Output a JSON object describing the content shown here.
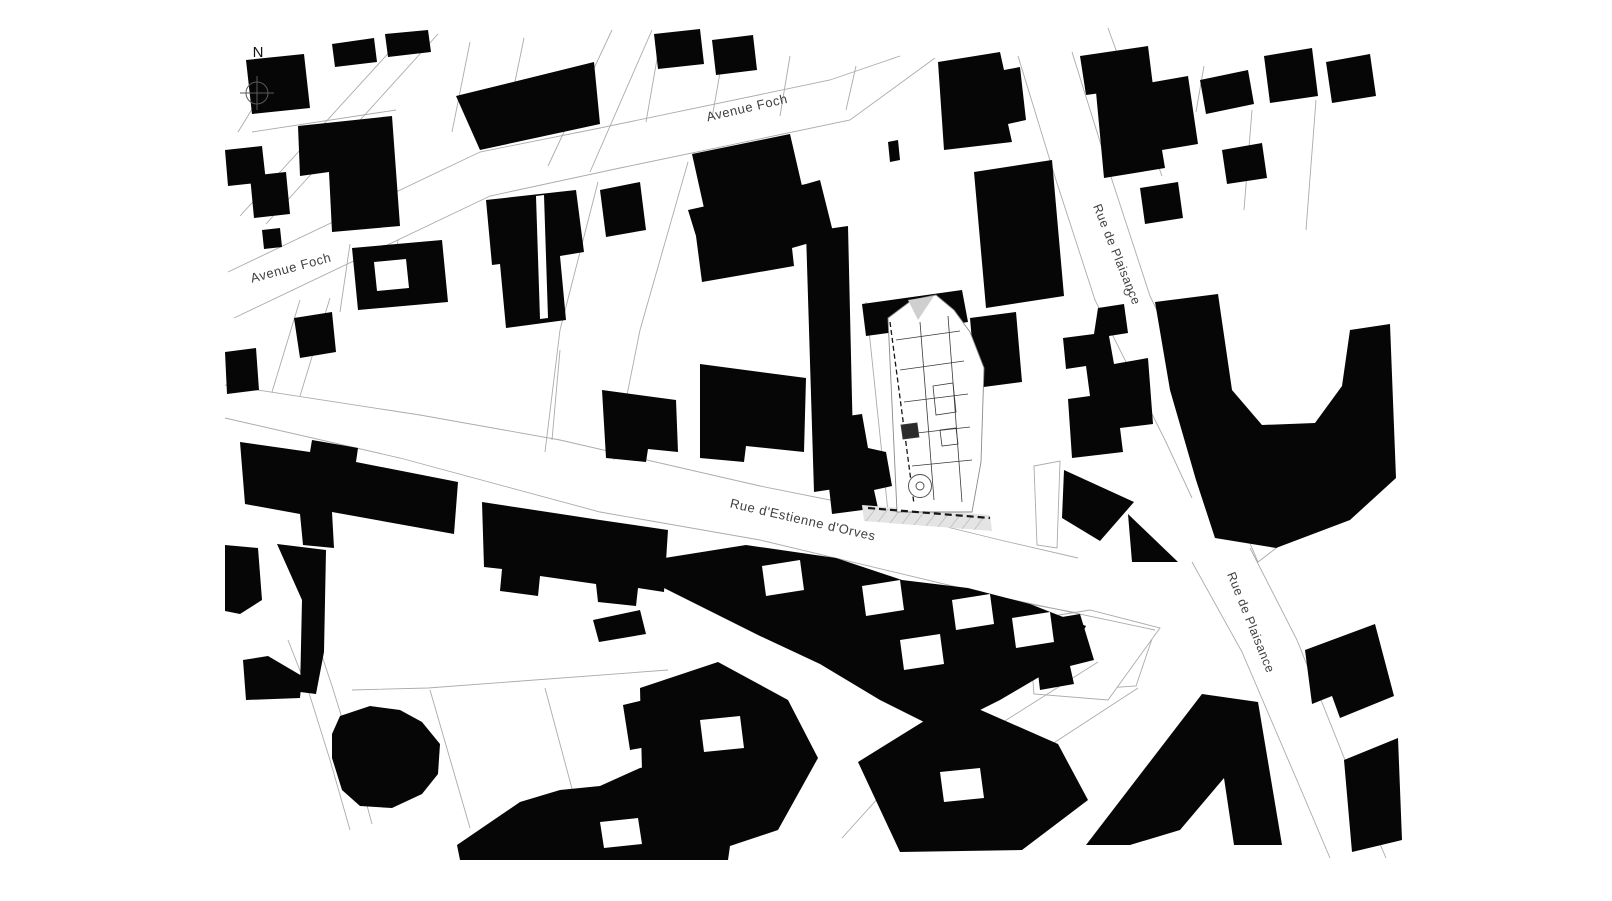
{
  "map": {
    "type": "architectural-site-plan-figure-ground",
    "colors": {
      "background": "#ffffff",
      "building": "#060606",
      "parcel_line": "#ababab",
      "label": "#3f3f3f",
      "site_line": "#3a3a3a",
      "hatch_fill": "#e4e4e4",
      "hatch_line": "#bbbbbb",
      "site_accent": "#cfcfcf"
    },
    "north": {
      "label": "N",
      "cx": 257,
      "cy": 93,
      "r": 11,
      "label_x": 258,
      "label_y": 76,
      "font": 15
    },
    "labels": [
      {
        "id": "avenue-foch-top",
        "text": "Avenue Foch",
        "x": 748,
        "y": 112,
        "rotate": -13,
        "size": 13
      },
      {
        "id": "avenue-foch-left",
        "text": "Avenue Foch",
        "x": 292,
        "y": 272,
        "rotate": -15,
        "size": 13
      },
      {
        "id": "rue-de-plaisance-top",
        "text": "Rue de Plaisance",
        "x": 1113,
        "y": 256,
        "rotate": 68,
        "size": 12.5
      },
      {
        "id": "rue-de-plaisance-bottom",
        "text": "Rue de Plaisance",
        "x": 1247,
        "y": 624,
        "rotate": 68,
        "size": 12.5
      },
      {
        "id": "rue-destienne-dorves",
        "text": "Rue d'Estienne d'Orves",
        "x": 802,
        "y": 524,
        "rotate": 13,
        "size": 13
      }
    ],
    "blocks": [
      "990,597 1100,617 1155,630 1136,686 1048,692 992,642",
      "1034,466 1060,461 1057,548 1037,545",
      "1240,520 1284,542 1258,562",
      "1028,620 1090,610 1160,628 1108,700 1034,694"
    ],
    "parcel_lines": [
      [
        228,
        272,
        480,
        152,
        600,
        128,
        830,
        80,
        900,
        56
      ],
      [
        234,
        318,
        490,
        196,
        620,
        168,
        850,
        120,
        935,
        58
      ],
      [
        404,
        36,
        240,
        216
      ],
      [
        438,
        34,
        266,
        224
      ],
      [
        300,
        300,
        272,
        392
      ],
      [
        330,
        298,
        300,
        396
      ],
      [
        612,
        30,
        548,
        166
      ],
      [
        652,
        30,
        590,
        172
      ],
      [
        598,
        182,
        560,
        330,
        545,
        452
      ],
      [
        688,
        162,
        640,
        330,
        614,
        460
      ],
      [
        1018,
        56,
        1056,
        180,
        1095,
        300,
        1165,
        440,
        1192,
        498
      ],
      [
        1072,
        52,
        1112,
        180,
        1150,
        296,
        1218,
        436,
        1248,
        500
      ],
      [
        225,
        385,
        420,
        415,
        560,
        440,
        760,
        486,
        870,
        508,
        1000,
        540,
        1078,
        558
      ],
      [
        225,
        418,
        400,
        458,
        600,
        512,
        760,
        540,
        990,
        595,
        1155,
        630
      ],
      [
        1138,
        688,
        1046,
        748,
        938,
        812,
        900,
        845
      ],
      [
        1098,
        662,
        1000,
        724,
        880,
        796,
        842,
        838
      ],
      [
        1192,
        562,
        1242,
        652,
        1302,
        792,
        1330,
        858
      ],
      [
        1250,
        548,
        1297,
        640,
        1357,
        790,
        1386,
        858
      ],
      [
        312,
        626,
        332,
        686,
        352,
        750,
        372,
        824
      ],
      [
        288,
        640,
        310,
        696,
        330,
        760,
        350,
        830
      ],
      [
        285,
        56,
        238,
        132
      ],
      [
        252,
        132,
        396,
        110
      ],
      [
        470,
        42,
        452,
        132
      ],
      [
        524,
        38,
        505,
        130
      ],
      [
        660,
        42,
        646,
        122
      ],
      [
        724,
        50,
        712,
        118
      ],
      [
        790,
        56,
        780,
        116
      ],
      [
        856,
        66,
        846,
        110
      ],
      [
        350,
        244,
        340,
        312
      ],
      [
        398,
        240,
        390,
        304
      ],
      [
        560,
        350,
        552,
        440
      ],
      [
        430,
        690,
        470,
        828
      ],
      [
        545,
        688,
        575,
        800
      ],
      [
        352,
        690,
        428,
        688,
        668,
        670
      ],
      [
        1140,
        52,
        1152,
        96
      ],
      [
        1204,
        66,
        1196,
        112
      ],
      [
        1108,
        28,
        1162,
        176
      ],
      [
        1252,
        110,
        1244,
        210
      ],
      [
        1316,
        100,
        1306,
        230
      ],
      [
        866,
        302,
        888,
        512
      ]
    ],
    "buildings": [
      "246,60 304,54 310,108 252,114",
      "298,126 392,116 400,226 332,232 329,172 300,176",
      "250,176 286,172 290,214 254,218",
      "262,230 280,228 282,247 264,249",
      "332,44 374,38 377,62 335,67",
      "385,34 428,30 431,52 388,57",
      "456,96 594,62 600,124 480,150",
      "486,200 576,190 584,252 560,256 566,320 506,328 500,264 492,265",
      "600,190 640,182 646,230 606,237",
      "654,34 700,29 704,64 658,69",
      "712,40 753,35 757,70 716,75",
      "692,154 790,134 802,186 704,208",
      "688,210 806,184 820,180 834,236 792,248 794,266 702,282 696,236",
      "938,62 1000,52 1004,70 1020,67 1026,120 1008,124 1012,142 944,150",
      "888,142 898,140 900,160 890,162",
      "974,172 1052,160 1064,296 986,308",
      "862,304 962,290 968,322 942,326 946,352 900,358 896,332 866,336",
      "970,318 1016,312 1022,382 976,388",
      "1098,308 1124,304 1128,333 1109,336 1114,364 1148,358 1153,424 1120,428 1123,452 1072,458 1068,399 1090,396 1086,366 1066,369 1063,338 1094,334",
      "1080,56 1148,46 1153,86 1086,95",
      "1096,92 1188,76 1198,144 1162,150 1165,168 1104,178",
      "1200,80 1248,70 1254,104 1206,114",
      "1264,56 1312,48 1318,96 1270,103",
      "1326,62 1370,54 1376,96 1332,103",
      "1140,188 1178,182 1183,218 1145,224",
      "1222,150 1262,143 1267,178 1227,184",
      "1155,302 1218,294 1232,390 1262,425 1315,423 1342,386 1350,330 1390,324 1396,478 1350,520 1276,548 1215,538 1196,480 1170,390",
      "1128,514 1178,562 1132,562",
      "1064,470 1134,502 1100,541 1062,518",
      "1086,845 1202,694 1258,702 1282,845 1234,845 1224,778 1180,830 1130,845",
      "1305,650 1375,624 1394,696 1340,718 1332,696 1312,704",
      "1344,760 1398,738 1402,840 1352,852",
      "1032,622 1080,614 1094,660 1070,666 1074,684 1040,690",
      "652,560 746,545 836,558 902,580 968,588 1030,604 1086,626 1068,660 1000,700 940,730 880,700 820,664 760,636 700,606 664,588",
      "640,688 718,662 788,700 818,758 778,830 700,856 644,856",
      "858,762 958,700 1058,744 1088,800 1022,850 900,852",
      "352,248 442,240 448,302 358,310",
      "294,318 332,312 336,352 300,358",
      "225,352 256,348 259,390 227,394",
      "240,442 310,452 312,440 358,448 356,462 458,482 454,534 332,512 334,548 303,545 300,514 245,504",
      "277,544 326,550 324,652 316,694 300,692 302,600",
      "243,660 268,656 302,676 300,698 246,700",
      "225,545 258,548 262,600 240,614 225,611",
      "482,502 600,520 668,530 664,592 638,588 636,606 598,602 596,584 540,576 538,596 500,591 502,569 484,567",
      "340,716 370,706 400,710 422,722 440,744 438,774 422,794 392,808 360,806 342,790 332,758 332,734",
      "457,845 520,802 560,790 600,786 640,768 672,762 700,772 722,802 732,832 728,860 460,860",
      "593,620 640,610 646,634 599,642",
      "623,705 678,692 684,740 630,750",
      "806,232 848,226 854,486 814,492",
      "700,364 806,378 804,452 746,446 744,462 700,458",
      "602,390 676,400 678,452 648,449 646,462 606,458",
      "820,420 862,414 868,448 886,452 892,486 874,490 878,508 832,514 828,478 816,476",
      "225,150 262,146 266,182 228,186"
    ],
    "overlays": [
      "762,566 800,560 804,590 766,596",
      "862,586 900,580 904,610 866,616",
      "952,600 990,594 994,624 956,630",
      "1012,618 1050,612 1054,642 1016,648",
      "1237,307 1338,302 1333,382 1297,410 1254,398 1240,350",
      "700,720 740,716 744,748 704,752",
      "940,772 980,768 984,798 944,802",
      "600,822 638,818 642,844 604,848",
      "374,262 406,259 409,288 377,291",
      "536,196 544,195 548,318 540,319",
      "900,640 940,634 944,664 904,670"
    ],
    "site": {
      "outline": "888,318 912,300 936,295 954,310 970,332 984,368 981,462 972,512 897,512",
      "walls": [
        "896,340 960,331",
        "900,370 964,361",
        "904,402 968,394",
        "908,434 970,427",
        "912,466 972,460",
        "920,322 934,500",
        "948,316 962,502"
      ],
      "dashed": [
        {
          "pts": "890,322 914,504",
          "dash": "5,3",
          "w": 1.3
        },
        {
          "pts": "868,508 990,518",
          "dash": "7,4",
          "w": 2.2
        }
      ],
      "shapes": [
        {
          "pts": "933,386 953,383 956,412 936,415",
          "fill": "none"
        },
        {
          "pts": "901,425 917,423 919,437 903,439",
          "fill": "#2b2b2b"
        },
        {
          "pts": "940,430 956,428 958,444 942,446",
          "fill": "none"
        },
        {
          "pts": "908,300 934,296 918,320",
          "fill": "#cfcfcf",
          "stroke": "none"
        }
      ],
      "hatch": {
        "poly": "862,505 990,515 992,531 864,521",
        "lines": [
          "866,521 876,508",
          "878,522 888,509",
          "890,523 900,510",
          "902,524 912,511",
          "914,525 924,512",
          "926,526 936,513",
          "938,527 948,514",
          "950,528 960,515",
          "962,529 972,516",
          "974,530 984,517"
        ]
      },
      "circles": [
        {
          "cx": 920,
          "cy": 486,
          "r": 11.5
        },
        {
          "cx": 920,
          "cy": 486,
          "r": 4
        },
        {
          "cx": 1127,
          "cy": 292,
          "r": 3
        }
      ]
    }
  }
}
